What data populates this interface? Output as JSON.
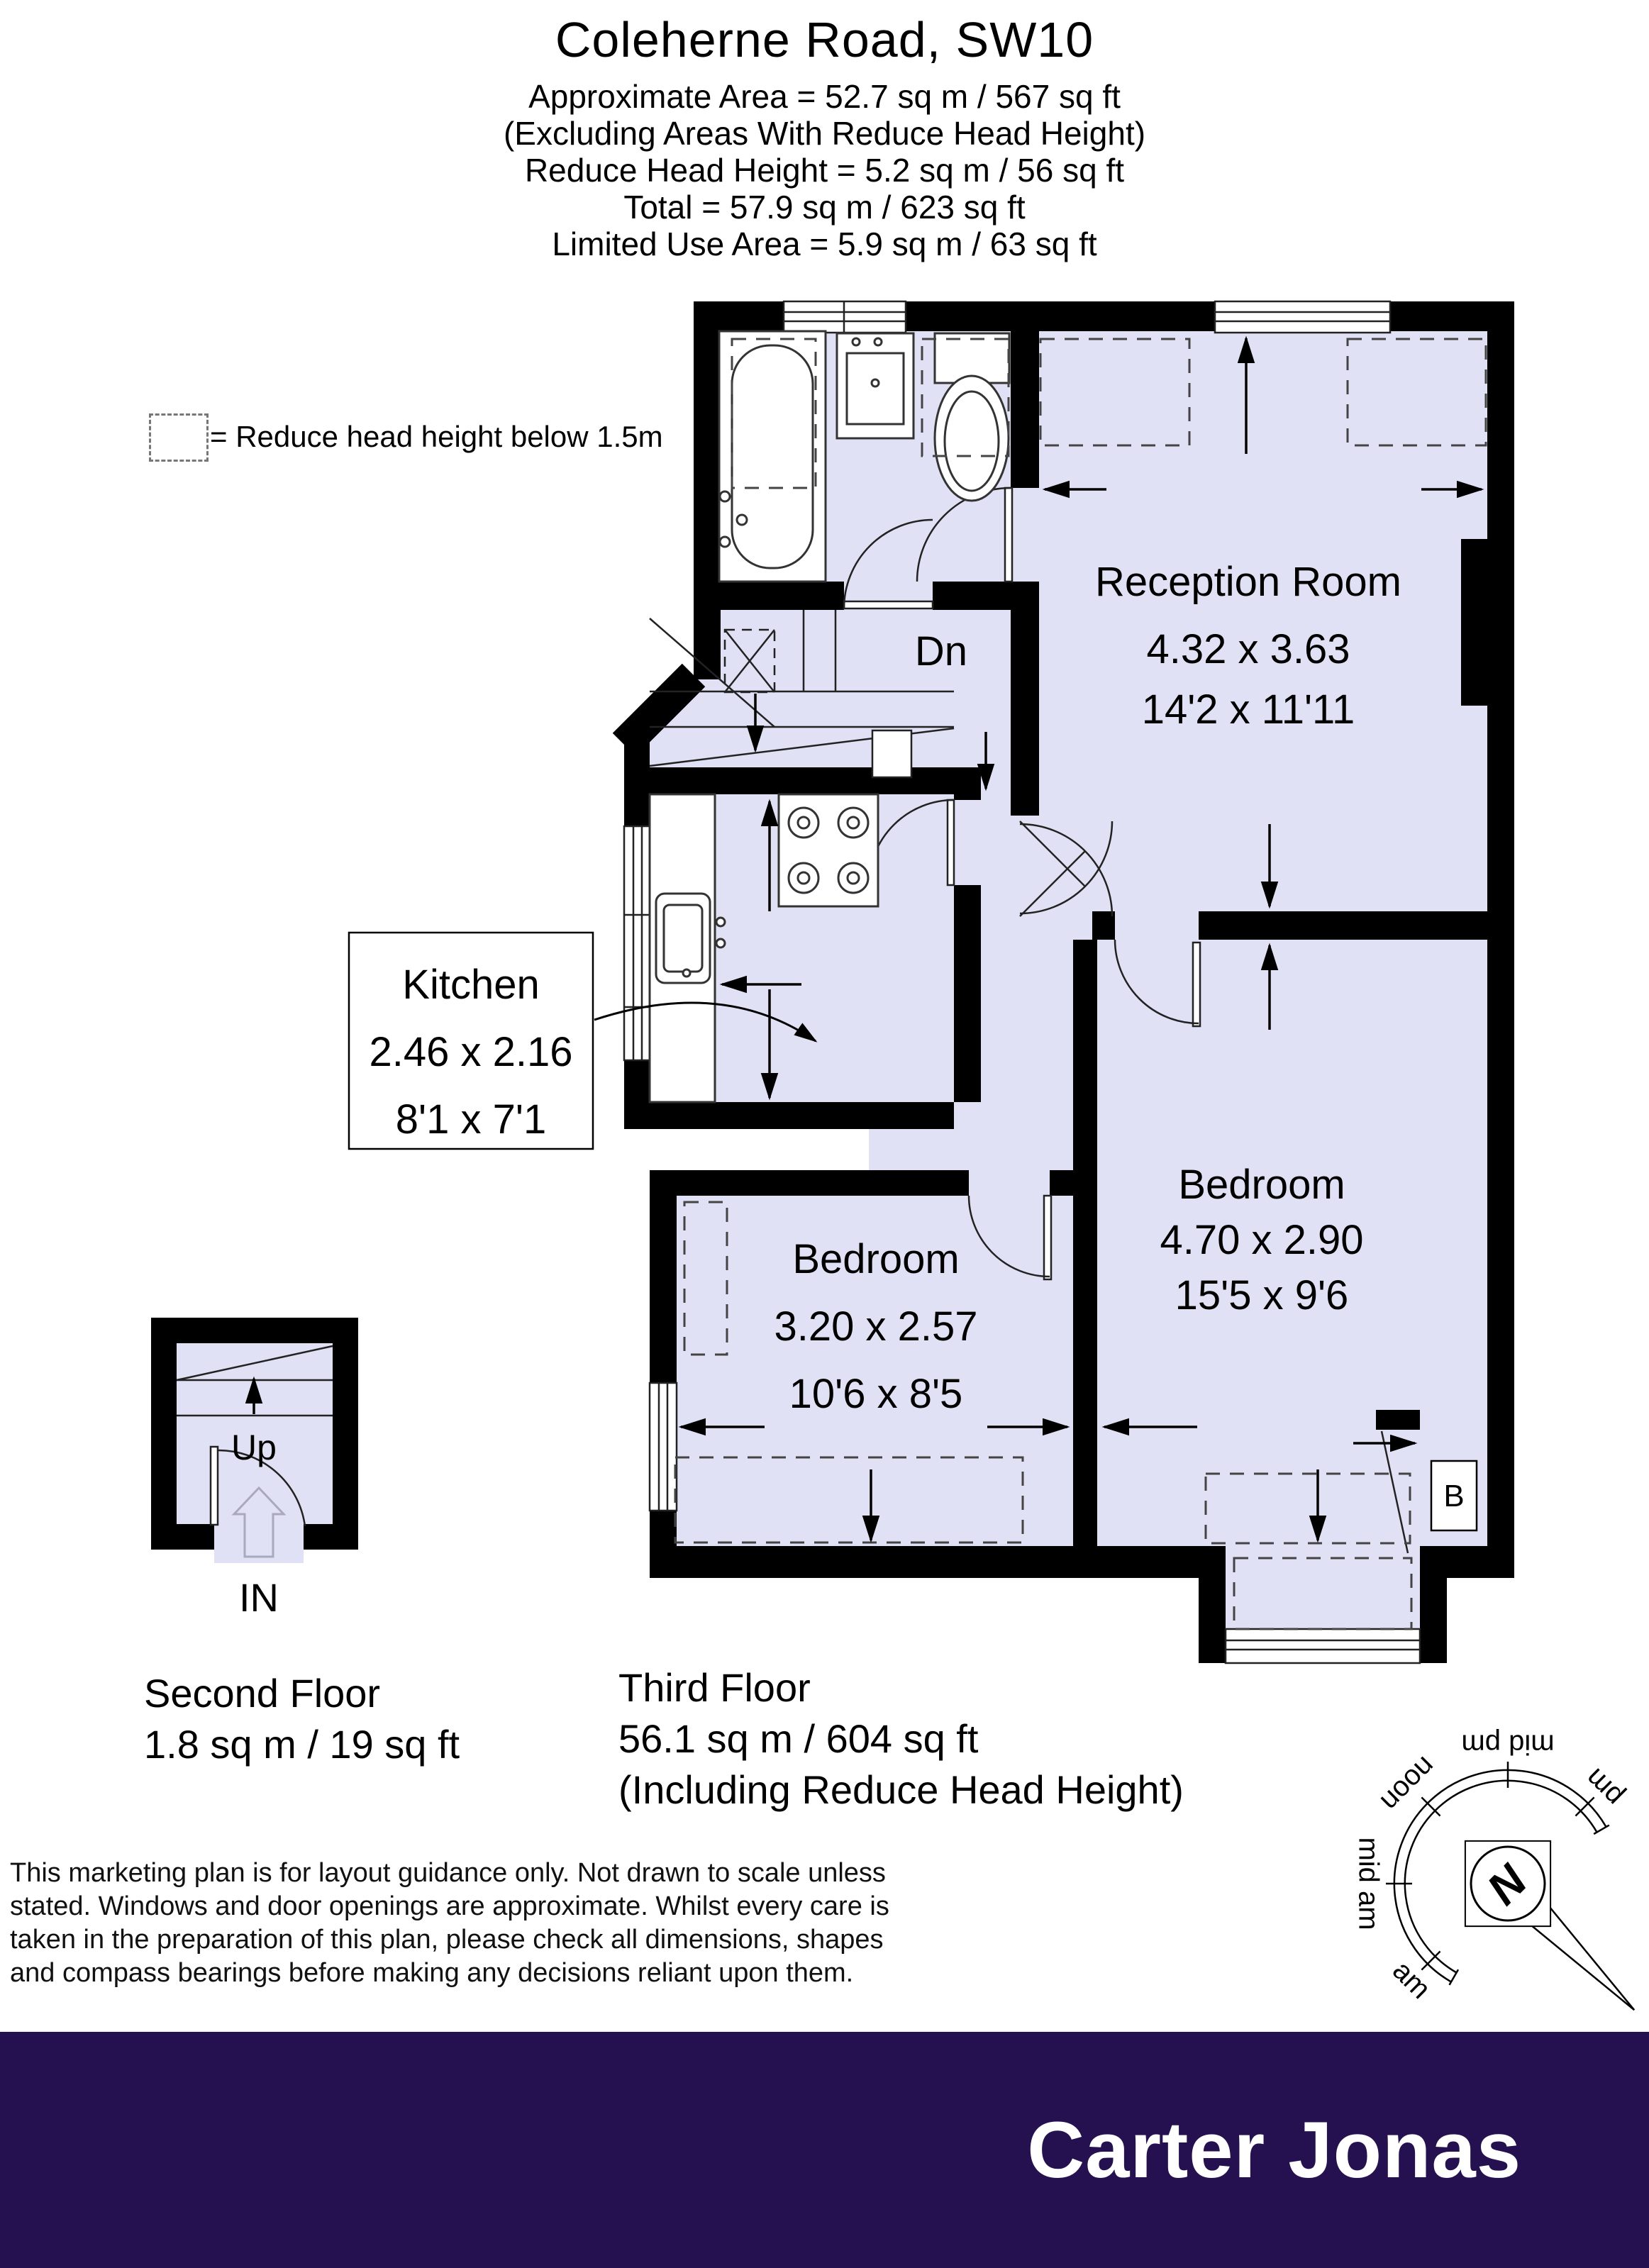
{
  "header": {
    "title": "Coleherne Road, SW10",
    "area_lines": [
      "Approximate Area = 52.7 sq m / 567 sq ft",
      "(Excluding Areas With Reduce Head Height)",
      "Reduce Head Height = 5.2 sq m / 56 sq ft",
      "Total = 57.9 sq m / 623 sq ft",
      "Limited Use Area = 5.9 sq m / 63 sq ft"
    ]
  },
  "legend": {
    "label": "= Reduce head height below 1.5m"
  },
  "plan": {
    "rooms": {
      "reception": {
        "name": "Reception Room",
        "dim_metric": "4.32 x 3.63",
        "dim_imperial": "14'2 x 11'11"
      },
      "kitchen": {
        "name": "Kitchen",
        "dim_metric": "2.46 x 2.16",
        "dim_imperial": "8'1 x 7'1"
      },
      "bedroom_small": {
        "name": "Bedroom",
        "dim_metric": "3.20 x 2.57",
        "dim_imperial": "10'6 x 8'5"
      },
      "bedroom_large": {
        "name": "Bedroom",
        "dim_metric": "4.70 x 2.90",
        "dim_imperial": "15'5 x 9'6"
      }
    },
    "labels": {
      "stairs_down": "Dn",
      "stairs_up": "Up",
      "entrance": "IN",
      "boiler": "B"
    }
  },
  "floors": {
    "second": {
      "name": "Second Floor",
      "area": "1.8 sq m / 19 sq ft"
    },
    "third": {
      "name": "Third Floor",
      "area": "56.1 sq m / 604 sq ft",
      "note": "(Including Reduce Head Height)"
    }
  },
  "compass": {
    "north": "N",
    "labels": {
      "am": "am",
      "mid_am": "mid am",
      "noon": "noon",
      "mid_pm": "mid pm",
      "pm": "pm"
    }
  },
  "disclaimer": {
    "lines": [
      "This marketing plan is for layout guidance only. Not drawn to scale unless",
      "stated. Windows and door openings are approximate. Whilst every care is",
      "taken in the preparation of this plan, please check all dimensions, shapes",
      "and compass bearings before making any decisions reliant upon them."
    ]
  },
  "footer": {
    "brand": "Carter Jonas"
  },
  "colors": {
    "floor": "#e0e1f4",
    "wall": "#000000",
    "footer_bg": "#261150",
    "brand_text": "#ffffff"
  }
}
